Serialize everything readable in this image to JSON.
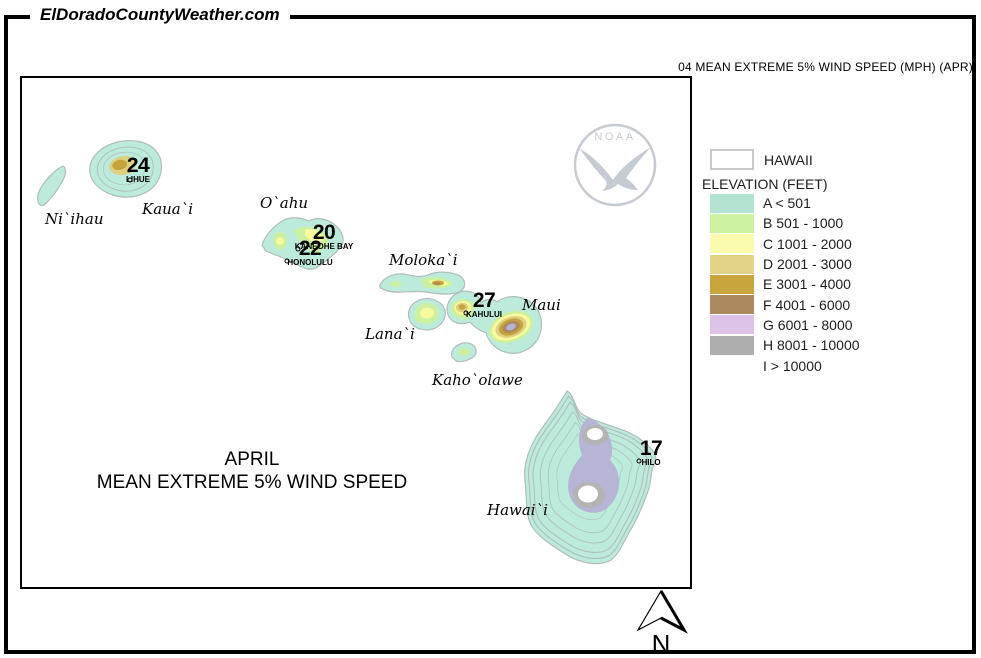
{
  "header": {
    "site_title": "ElDoradoCountyWeather.com",
    "map_code_title": "04 MEAN EXTREME 5% WIND SPEED (MPH) (APR)"
  },
  "map": {
    "caption": {
      "line1": "APRIL",
      "line2": "MEAN EXTREME 5% WIND SPEED"
    },
    "noaa": {
      "label": "NOAA"
    },
    "compass": {
      "label": "N"
    },
    "islands": [
      {
        "name": "Ni`ihau"
      },
      {
        "name": "Kaua`i"
      },
      {
        "name": "O`ahu"
      },
      {
        "name": "Moloka`i"
      },
      {
        "name": "Lana`i"
      },
      {
        "name": "Maui"
      },
      {
        "name": "Kaho`olawe"
      },
      {
        "name": "Hawai`i"
      }
    ],
    "stations": [
      {
        "value": "24",
        "name": "LIHUE"
      },
      {
        "value": "20",
        "name": "KANEOHE BAY"
      },
      {
        "value": "22",
        "name": "HONOLULU"
      },
      {
        "value": "27",
        "name": "KAHULUI"
      },
      {
        "value": "17",
        "name": "HILO"
      }
    ]
  },
  "legend": {
    "region_label": "HAWAII",
    "title": "ELEVATION (FEET)",
    "rows": [
      {
        "label": "A < 501",
        "color": "#b2e3d0"
      },
      {
        "label": "B 501 - 1000",
        "color": "#cdf2a2"
      },
      {
        "label": "C 1001 - 2000",
        "color": "#fbfbb0"
      },
      {
        "label": "D 2001 - 3000",
        "color": "#e2d388"
      },
      {
        "label": "E 3001 - 4000",
        "color": "#c9a53e"
      },
      {
        "label": "F 4001 - 6000",
        "color": "#ab8a5f"
      },
      {
        "label": "G 6001 - 8000",
        "color": "#dec3e8"
      },
      {
        "label": "H 8001 - 10000",
        "color": "#aeaeae"
      },
      {
        "label": "I > 10000",
        "color": "#ffffff"
      }
    ]
  }
}
